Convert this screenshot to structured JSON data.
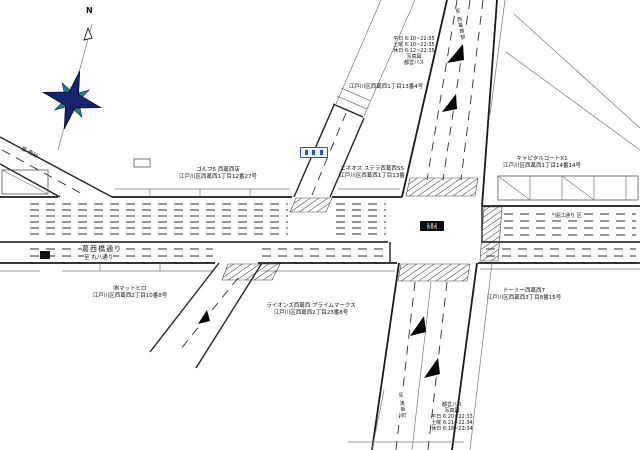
{
  "compass": {
    "north_label": "N"
  },
  "roads": {
    "main_name": "葛西橋通り",
    "main_to": "至 丸八通り",
    "east_side_street": "堀江通り 区",
    "west_branch_to": "至 南砂",
    "north_branch_to": "至 西葛西駅",
    "south_branch_to": "至 清新町",
    "intersection_sign": "西葛西"
  },
  "landmarks": [
    {
      "name": "ゴルフ5 西葛西店",
      "address": "江戸川区西葛西1丁目12番27号"
    },
    {
      "name": "エネオス ステラ西葛西SS",
      "address": "江戸川区西葛西1丁目13番"
    },
    {
      "name": "",
      "address": "江戸川区西葛西1丁目13番4号"
    },
    {
      "name": "キャピタルコートX1",
      "address": "江戸川区西葛西1丁目14番14号"
    },
    {
      "name": "㈱マットヒロ",
      "address": "江戸川区西葛西2丁目10番8号"
    },
    {
      "name": "ライオンズ西葛西 プライムマークス",
      "address": "江戸川区西葛西2丁目23番8号"
    },
    {
      "name": "ドーミー西葛西7",
      "address": "江戸川区西葛西3丁目8番15号"
    }
  ],
  "bus_info_top": {
    "weekday": "平日 6:10~22:35",
    "saturday": "土曜 6:10~22:35",
    "holiday": "休日 6:12~22:35",
    "note1": "写真図",
    "note2": "都営バス"
  },
  "bus_info_bottom": {
    "operator": "都営バス",
    "note": "写真図",
    "weekday": "平日 6:20~22:33",
    "saturday": "土曜 6:21~22:34",
    "holiday": "休日 6:18~22:34"
  }
}
